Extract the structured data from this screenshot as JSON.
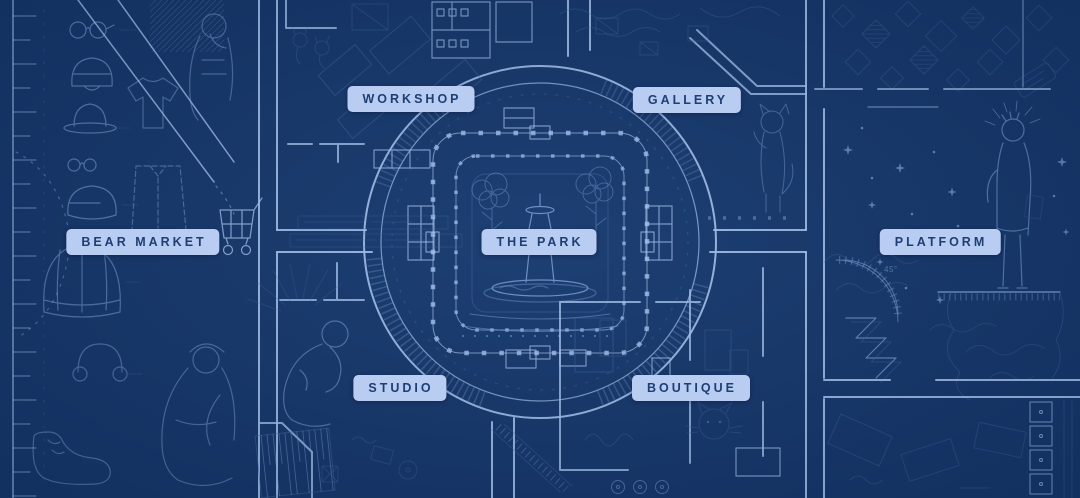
{
  "map": {
    "name": "blueprint-town-map",
    "districts": [
      {
        "id": "bear-market",
        "label": "BEAR MARKET"
      },
      {
        "id": "workshop",
        "label": "WORKSHOP"
      },
      {
        "id": "gallery",
        "label": "GALLERY"
      },
      {
        "id": "the-park",
        "label": "THE PARK"
      },
      {
        "id": "platform",
        "label": "PLATFORM"
      },
      {
        "id": "studio",
        "label": "STUDIO"
      },
      {
        "id": "boutique",
        "label": "BOUTIQUE"
      }
    ],
    "annotations": {
      "angle_note": "45°"
    },
    "colors": {
      "background": "#15376B",
      "line_bright": "#A6C4F0",
      "line_medium": "#7FA5DA",
      "line_faint": "#3F66A0",
      "label_bg": "#B9CDF2",
      "label_text": "#1E3F73"
    }
  }
}
